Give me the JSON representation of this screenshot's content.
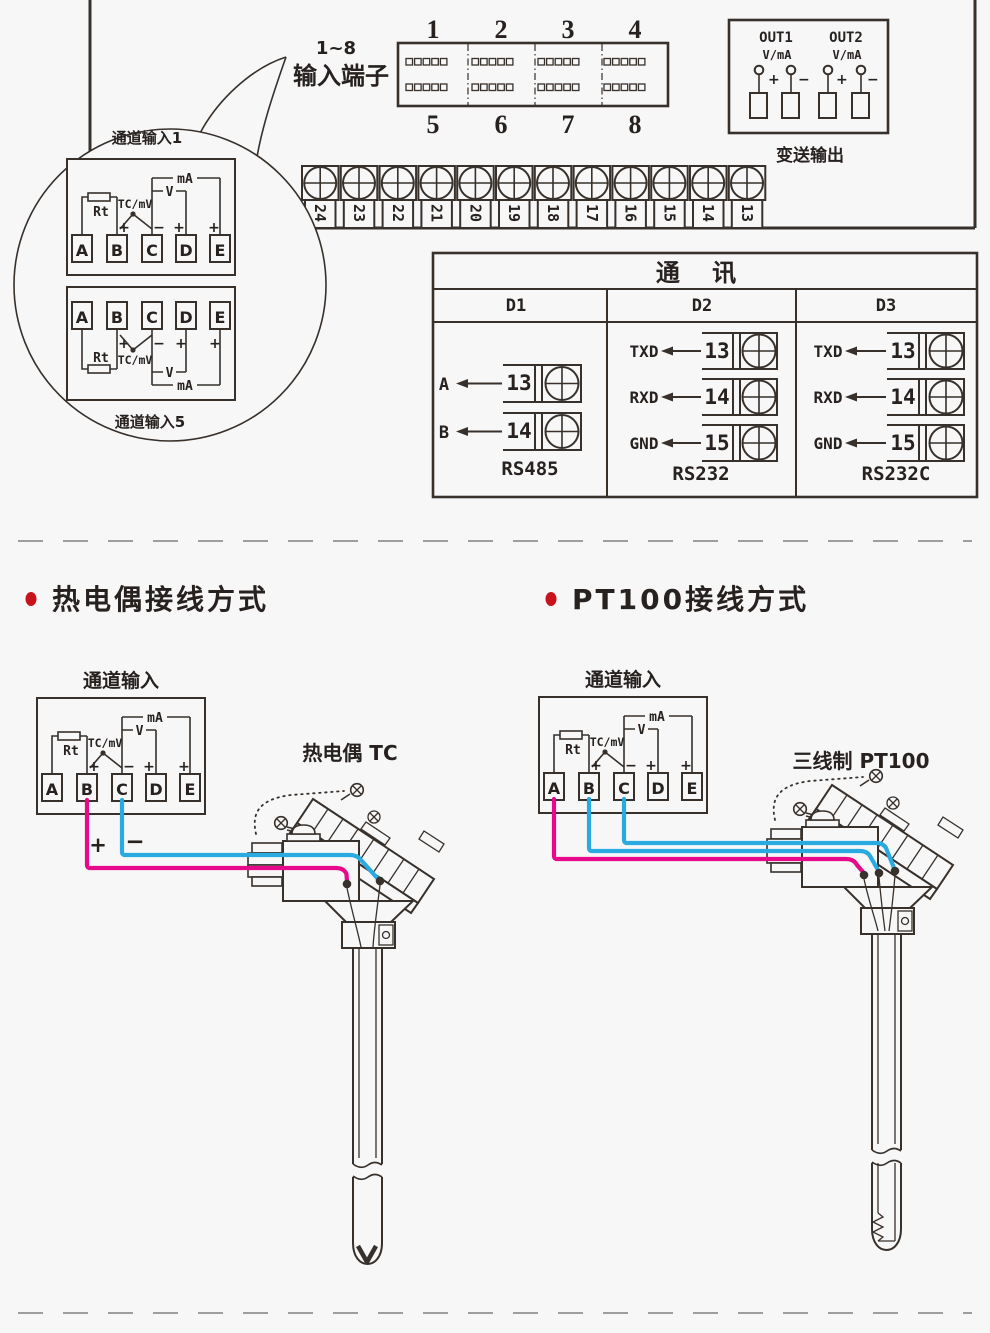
{
  "colors": {
    "background": "#f7f7f7",
    "line": "#37302b",
    "wire_positive_pink": "#e60a8b",
    "wire_negative_blue": "#29abe2",
    "bullet_red": "#c9131c"
  },
  "connector": {
    "range": "1~8",
    "label": "输入端子",
    "top_nums": [
      "1",
      "2",
      "3",
      "4"
    ],
    "bottom_nums": [
      "5",
      "6",
      "7",
      "8"
    ]
  },
  "output": {
    "out1": "OUT1",
    "out2": "OUT2",
    "vma": "V/mA",
    "plus": "+",
    "minus": "−",
    "caption": "变送输出"
  },
  "strip": {
    "nums": [
      "24",
      "23",
      "22",
      "21",
      "20",
      "19",
      "18",
      "17",
      "16",
      "15",
      "14",
      "13"
    ]
  },
  "callout": {
    "ch1": "通道输入1",
    "ch5": "通道输入5"
  },
  "channel_box": {
    "terminals": [
      "A",
      "B",
      "C",
      "D",
      "E"
    ],
    "rt": "Rt",
    "tc": "TC/mV",
    "v": "V",
    "ma": "mA",
    "plus": "+",
    "minus": "−"
  },
  "comm": {
    "title": "通 讯",
    "d1": {
      "header": "D1",
      "row1_signal": "A",
      "row1_num": "13",
      "row2_signal": "B",
      "row2_num": "14",
      "caption": "RS485"
    },
    "d2": {
      "header": "D2",
      "row1_signal": "TXD",
      "row1_num": "13",
      "row2_signal": "RXD",
      "row2_num": "14",
      "row3_signal": "GND",
      "row3_num": "15",
      "caption": "RS232"
    },
    "d3": {
      "header": "D3",
      "row1_signal": "TXD",
      "row1_num": "13",
      "row2_signal": "RXD",
      "row2_num": "14",
      "row3_signal": "GND",
      "row3_num": "15",
      "caption": "RS232C"
    }
  },
  "tc_section": {
    "heading": "热电偶接线方式",
    "box_title": "通道输入",
    "sensor_label": "热电偶 TC",
    "plus": "+",
    "minus": "−"
  },
  "pt_section": {
    "heading": "PT100接线方式",
    "box_title": "通道输入",
    "sensor_label": "三线制 PT100"
  }
}
